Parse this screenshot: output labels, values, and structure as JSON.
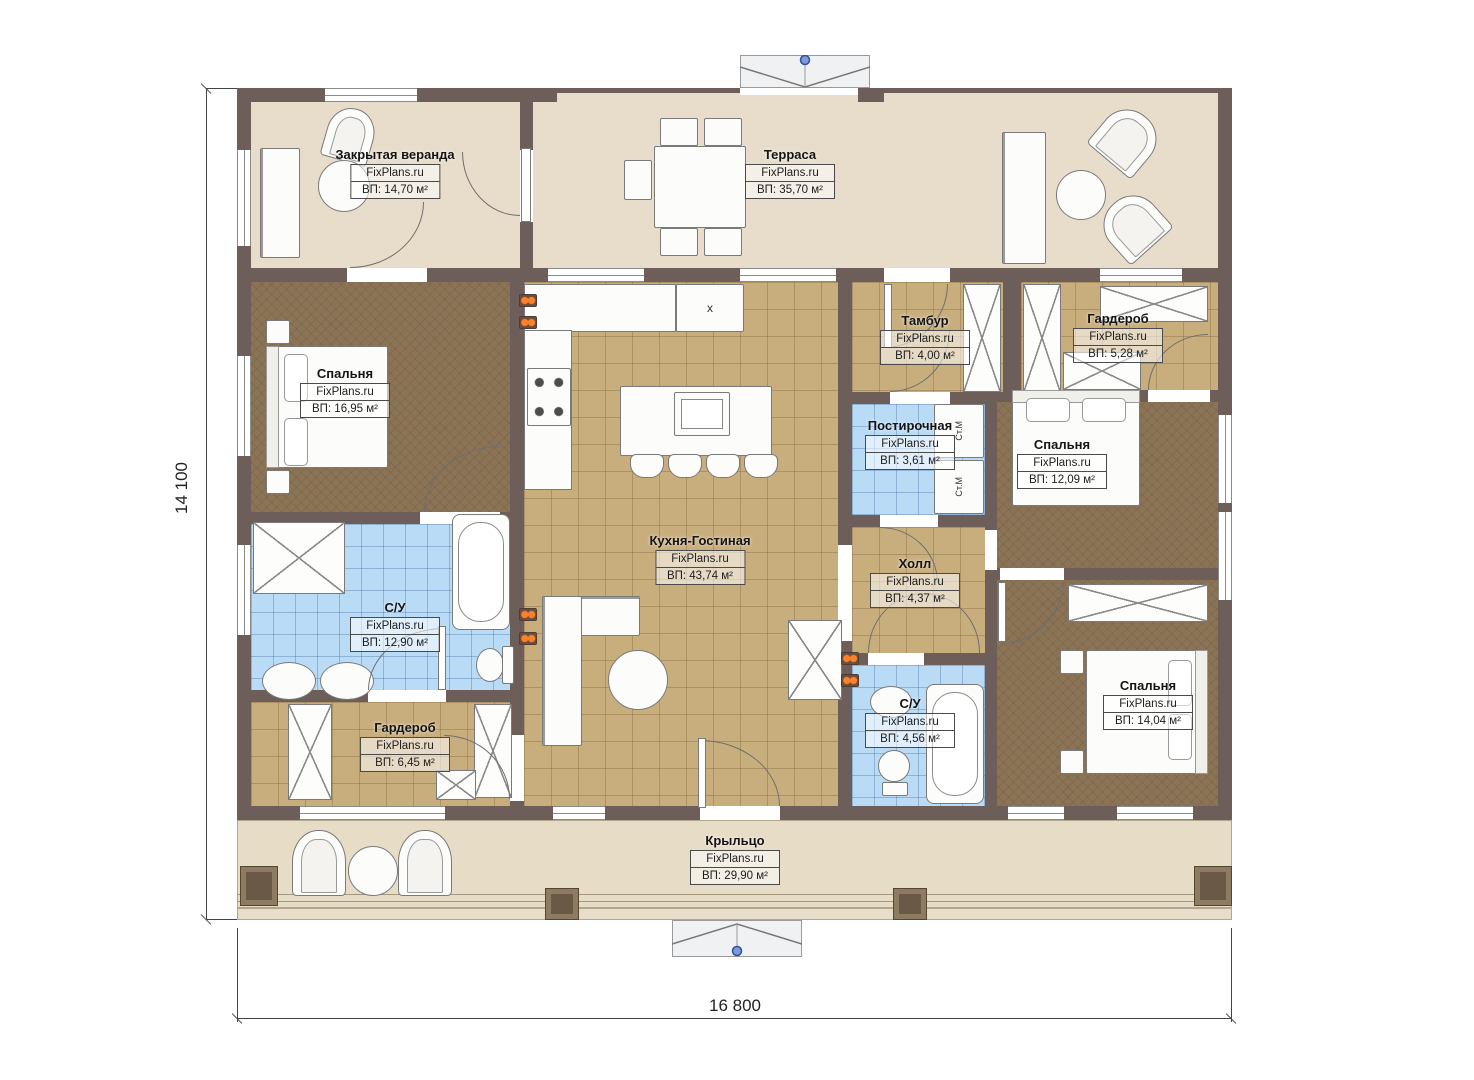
{
  "watermark": "FixPlans.ru",
  "dimensions": {
    "width": "16 800",
    "height": "14 100"
  },
  "rooms": [
    {
      "name": "Закрытая веранда",
      "area": "ВП: 14,70 м²"
    },
    {
      "name": "Терраса",
      "area": "ВП: 35,70 м²"
    },
    {
      "name": "Спальня",
      "area": "ВП: 16,95 м²"
    },
    {
      "name": "Кухня-Гостиная",
      "area": "ВП: 43,74 м²"
    },
    {
      "name": "Тамбур",
      "area": "ВП: 4,00 м²"
    },
    {
      "name": "Гардероб",
      "area": "ВП: 5,28 м²"
    },
    {
      "name": "Постирочная",
      "area": "ВП: 3,61 м²"
    },
    {
      "name": "Спальня",
      "area": "ВП: 12,09 м²"
    },
    {
      "name": "Холл",
      "area": "ВП: 4,37 м²"
    },
    {
      "name": "С/У",
      "area": "ВП: 12,90 м²"
    },
    {
      "name": "Гардероб",
      "area": "ВП: 6,45 м²"
    },
    {
      "name": "С/У",
      "area": "ВП: 4,56 м²"
    },
    {
      "name": "Спальня",
      "area": "ВП: 14,04 м²"
    },
    {
      "name": "Крыльцо",
      "area": "ВП: 29,90 м²"
    }
  ],
  "annotations": {
    "washer": "Ст.М",
    "fridge": "x"
  }
}
